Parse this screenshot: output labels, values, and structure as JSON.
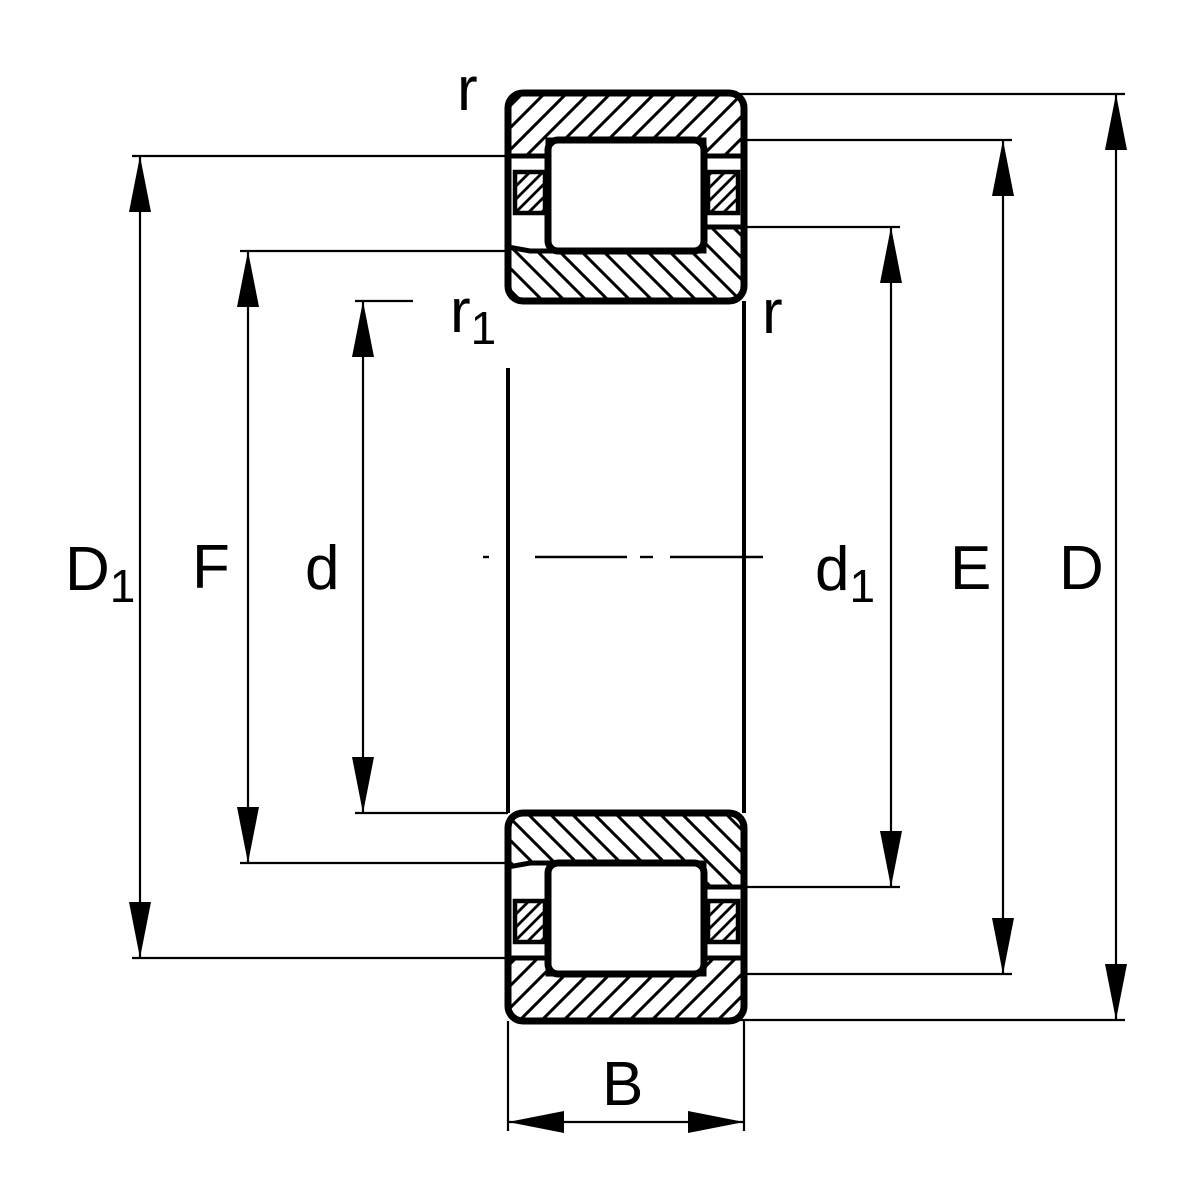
{
  "canvas": {
    "width": 1200,
    "height": 1200,
    "background": "#ffffff",
    "ink": "#000000"
  },
  "diagram": {
    "type": "technical-drawing",
    "view": "bearing-cross-section",
    "labels": {
      "D1": {
        "base": "D",
        "sub": "1"
      },
      "F": {
        "base": "F"
      },
      "d": {
        "base": "d"
      },
      "d1": {
        "base": "d",
        "sub": "1"
      },
      "E": {
        "base": "E"
      },
      "D": {
        "base": "D"
      },
      "B": {
        "base": "B"
      },
      "r_top": {
        "base": "r"
      },
      "r1": {
        "base": "r",
        "sub": "1"
      },
      "r_right": {
        "base": "r"
      }
    }
  }
}
